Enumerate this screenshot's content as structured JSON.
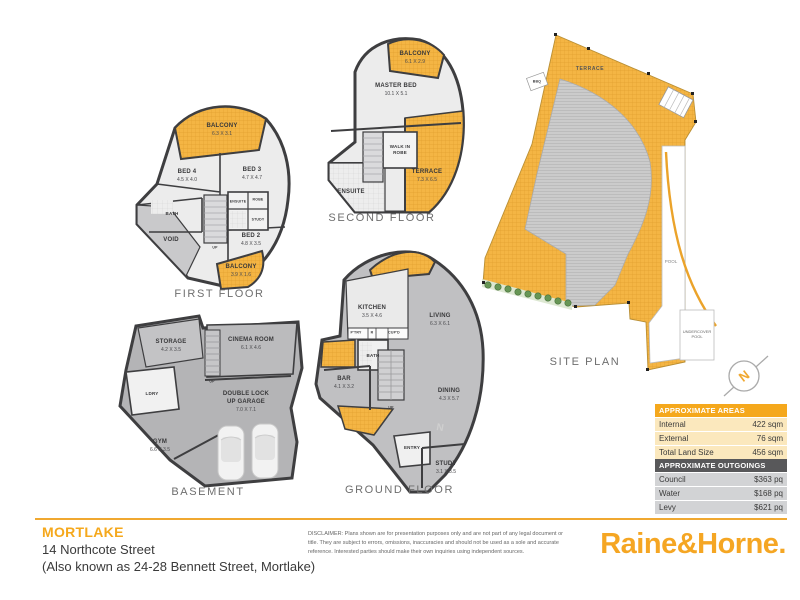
{
  "page": {
    "suburb": "MORTLAKE",
    "address_line1": "14 Northcote Street",
    "address_line2": "(Also known as 24-28 Bennett Street, Mortlake)",
    "disclaimer": "DISCLAIMER: Plans shown are for presentation purposes only and are not part of any legal document or title. They are subject to errors, omissions, inaccuracies and should not be used as a sole and accurate reference. Interested parties should make their own inquiries using independent sources.",
    "brand": "Raine&Horne."
  },
  "colors": {
    "accent_gold": "#F5A81C",
    "balcony_yellow": "#F4B544",
    "table_header_dark": "#58585A",
    "floor_light": "#ECECEC",
    "floor_mid": "#C0C0C2",
    "wall": "#3E3E40"
  },
  "compass": {
    "label": "N"
  },
  "plans": {
    "first_floor": {
      "label": "FIRST FLOOR",
      "rooms": {
        "balcony_top": {
          "name": "BALCONY",
          "dims": "6.3 X 3.1"
        },
        "bed4": {
          "name": "BED 4",
          "dims": "4.5 X 4.0"
        },
        "bed3": {
          "name": "BED 3",
          "dims": "4.7 X 4.7"
        },
        "bath": {
          "name": "BATH"
        },
        "robe": {
          "name": "ROBE"
        },
        "ensuite": {
          "name": "ENSUITE"
        },
        "study": {
          "name": "STUDY"
        },
        "void": {
          "name": "VOID"
        },
        "bed2": {
          "name": "BED 2",
          "dims": "4.8 X 3.5"
        },
        "balcony_bottom": {
          "name": "BALCONY",
          "dims": "3.9 X 1.6"
        },
        "up": {
          "name": "UP"
        }
      }
    },
    "second_floor": {
      "label": "SECOND FLOOR",
      "rooms": {
        "balcony": {
          "name": "BALCONY",
          "dims": "6.1 X 2.9"
        },
        "master": {
          "name": "MASTER BED",
          "dims": "10.1 X 5.1"
        },
        "wir": {
          "name": "WALK IN ROBE"
        },
        "terrace": {
          "name": "TERRACE",
          "dims": "7.3 X 6.5"
        },
        "ensuite": {
          "name": "ENSUITE"
        }
      }
    },
    "basement": {
      "label": "BASEMENT",
      "rooms": {
        "storage": {
          "name": "STORAGE",
          "dims": "4.2 X 3.5"
        },
        "cinema": {
          "name": "CINEMA ROOM",
          "dims": "6.1 X 4.6"
        },
        "ldry": {
          "name": "LDRY"
        },
        "garage": {
          "name": "DOUBLE LOCK UP GARAGE",
          "dims": "7.0 X 7.1"
        },
        "gym": {
          "name": "GYM",
          "dims": "6.6 X 3.5"
        },
        "up": {
          "name": "UP"
        }
      }
    },
    "ground_floor": {
      "label": "GROUND FLOOR",
      "rooms": {
        "kitchen": {
          "name": "KITCHEN",
          "dims": "3.5 X 4.6"
        },
        "ptry": {
          "name": "P'TRY"
        },
        "fridge": {
          "name": "R"
        },
        "cupd": {
          "name": "CUP'D"
        },
        "living": {
          "name": "LIVING",
          "dims": "6.3 X 6.1"
        },
        "bath": {
          "name": "BATH"
        },
        "bar": {
          "name": "BAR",
          "dims": "4.1 X 3.2"
        },
        "dining": {
          "name": "DINING",
          "dims": "4.3 X 5.7"
        },
        "entry": {
          "name": "ENTRY"
        },
        "study": {
          "name": "STUDY",
          "dims": "3.1 X 3.5"
        },
        "up": {
          "name": "UP"
        },
        "nmark": {
          "name": "N"
        }
      }
    },
    "site_plan": {
      "label": "SITE PLAN",
      "rooms": {
        "terrace": {
          "name": "TERRACE"
        },
        "bbq": {
          "name": "BBQ"
        },
        "pool": {
          "name": "POOL"
        },
        "undercover_pool": {
          "name": "UNDERCOVER POOL"
        }
      }
    }
  },
  "areas_table": {
    "title": "APPROXIMATE AREAS",
    "rows": [
      {
        "label": "Internal",
        "value": "422 sqm"
      },
      {
        "label": "External",
        "value": "76 sqm"
      },
      {
        "label": "Total Land Size",
        "value": "456 sqm"
      }
    ]
  },
  "outgoings_table": {
    "title": "APPROXIMATE OUTGOINGS",
    "rows": [
      {
        "label": "Council",
        "value": "$363 pq"
      },
      {
        "label": "Water",
        "value": "$168 pq"
      },
      {
        "label": "Levy",
        "value": "$621 pq"
      }
    ]
  }
}
